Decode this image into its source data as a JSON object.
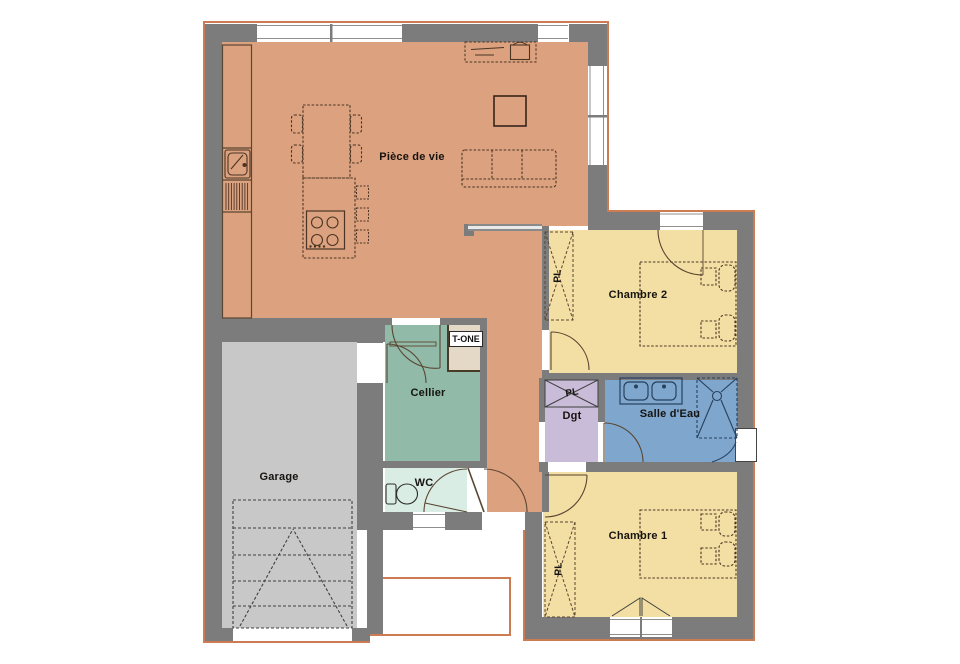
{
  "plan_title": "floor-plan",
  "rooms": [
    {
      "key": "piece_de_vie",
      "label": "Pièce de vie",
      "color": "#DCA17E"
    },
    {
      "key": "cellier",
      "label": "Cellier",
      "color": "#92BAA8"
    },
    {
      "key": "wc",
      "label": "WC",
      "color": "#D9EDE5"
    },
    {
      "key": "garage",
      "label": "Garage",
      "color": "#C8C8C8"
    },
    {
      "key": "chambre2",
      "label": "Chambre 2",
      "color": "#F3DFA3"
    },
    {
      "key": "chambre1",
      "label": "Chambre 1",
      "color": "#F3DFA3"
    },
    {
      "key": "salle_deau",
      "label": "Salle d'Eau",
      "color": "#7FA7CD"
    },
    {
      "key": "dgt",
      "label": "Dgt",
      "color": "#C9BCD9"
    }
  ],
  "annotations": {
    "closet": "PL",
    "tech_unit": "T-ONE"
  },
  "colors": {
    "wall": "#7C7C7C",
    "exterior_outline": "#CC7B52",
    "furniture_line": "#4a3525",
    "tech_unit_fill": "#E3D9C6",
    "window": "#FFFFFF"
  }
}
